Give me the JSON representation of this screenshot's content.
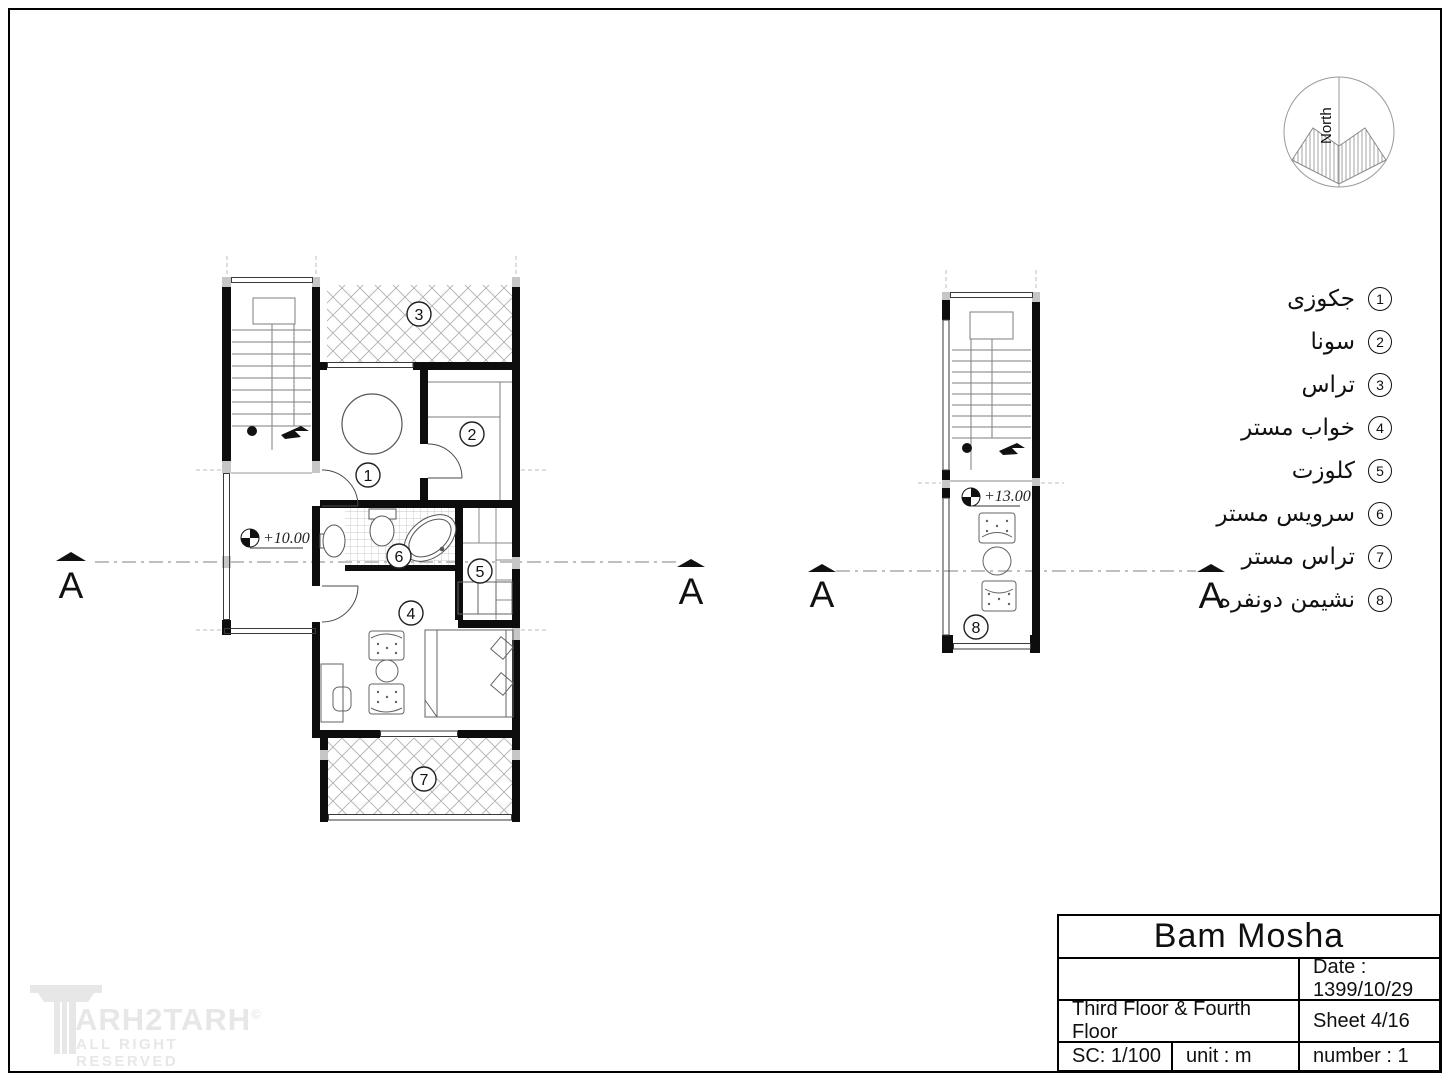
{
  "north": {
    "label": "North"
  },
  "section": {
    "label": "A"
  },
  "legend": {
    "items": [
      {
        "num": "1",
        "label": "جکوزی"
      },
      {
        "num": "2",
        "label": "سونا"
      },
      {
        "num": "3",
        "label": "تراس"
      },
      {
        "num": "4",
        "label": "خواب مستر"
      },
      {
        "num": "5",
        "label": "کلوزت"
      },
      {
        "num": "6",
        "label": "سرویس مستر"
      },
      {
        "num": "7",
        "label": "تراس مستر"
      },
      {
        "num": "8",
        "label": "نشیمن دونفره"
      }
    ]
  },
  "plans": {
    "left": {
      "level": "+10.00",
      "rooms": [
        "1",
        "2",
        "3",
        "4",
        "5",
        "6",
        "7"
      ]
    },
    "right": {
      "level": "+13.00",
      "rooms": [
        "8"
      ]
    }
  },
  "title_block": {
    "title": "Bam Mosha",
    "date": "Date : 1399/10/29",
    "floor_label": "Third Floor & Fourth Floor",
    "sheet_label": "Sheet 4/16",
    "scale": "SC: 1/100",
    "unit": "unit : m",
    "number": "number : 1"
  },
  "watermark": {
    "brand": "ARH2TARH",
    "copyright": "©",
    "tagline": "ALL RIGHT RESERVED"
  }
}
